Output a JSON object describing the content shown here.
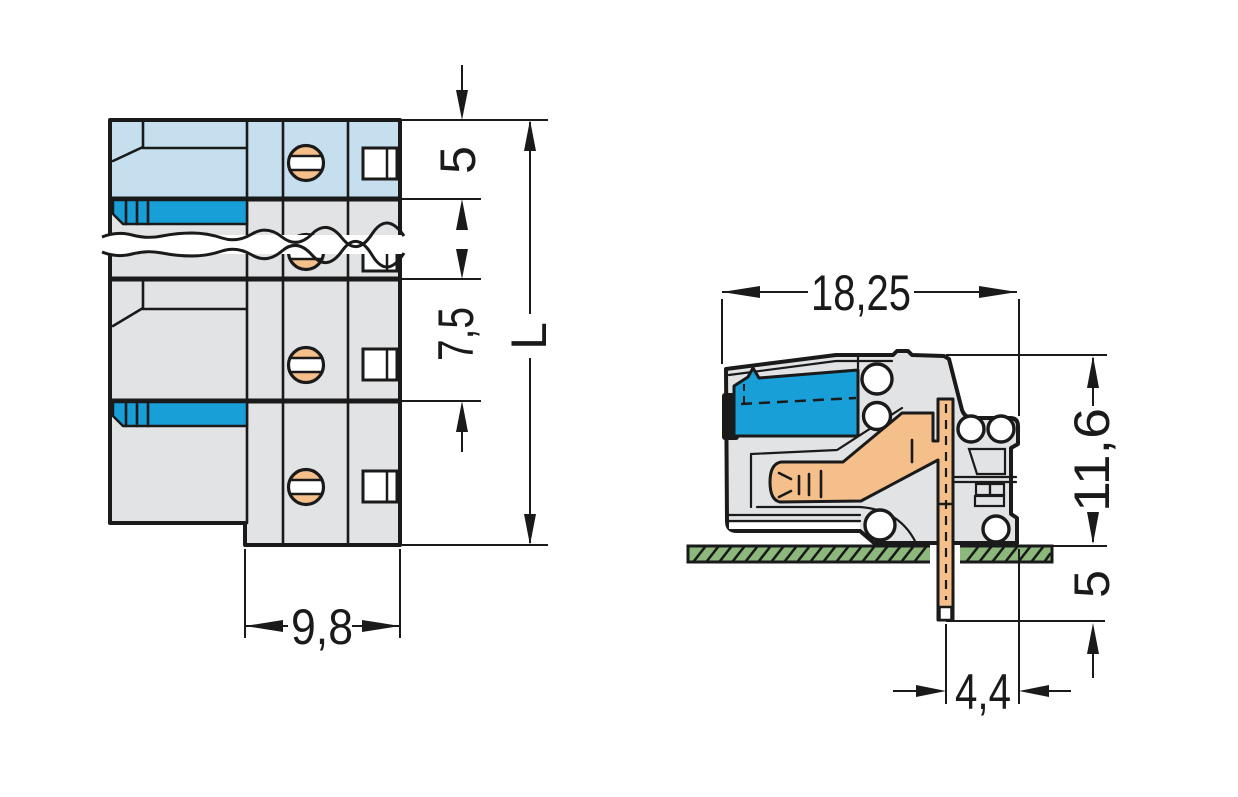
{
  "colors": {
    "line": "#1a1a1a",
    "body_gray": "#e2e3e5",
    "face_blue": "#c5dfee",
    "lock_blue": "#189fd7",
    "copper": "#f4bf8b",
    "board_green": "#8cb87c",
    "white": "#ffffff"
  },
  "front_view": {
    "dims": {
      "end_height": "5",
      "pitch": "7,5",
      "length": "L",
      "depth": "9,8"
    }
  },
  "side_view": {
    "dims": {
      "depth": "18,25",
      "height": "11,6",
      "pin_length": "5",
      "pin_offset": "4,4"
    }
  }
}
